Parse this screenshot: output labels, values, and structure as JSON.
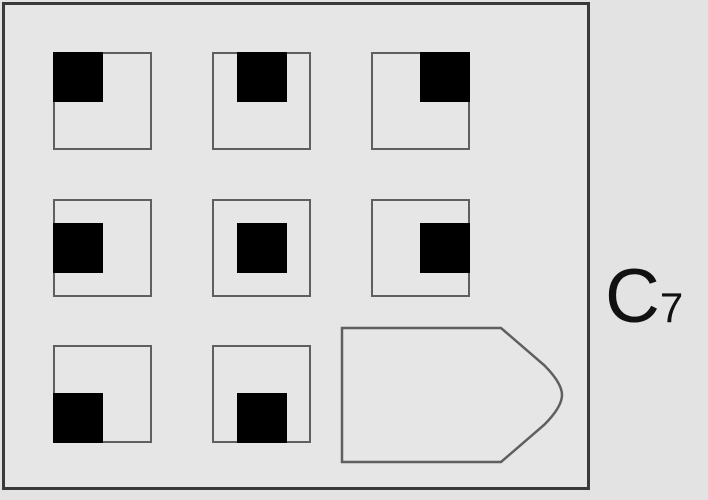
{
  "puzzle": {
    "label": {
      "text": "C",
      "subscript": "7"
    },
    "matrix": {
      "rows": 3,
      "cols": 3,
      "cells": [
        {
          "position": "row1-col1",
          "type": "square",
          "fill_position": "top-left"
        },
        {
          "position": "row1-col2",
          "type": "square",
          "fill_position": "top-center"
        },
        {
          "position": "row1-col3",
          "type": "square",
          "fill_position": "top-right"
        },
        {
          "position": "row2-col1",
          "type": "square",
          "fill_position": "middle-left"
        },
        {
          "position": "row2-col2",
          "type": "square",
          "fill_position": "middle-center"
        },
        {
          "position": "row2-col3",
          "type": "square",
          "fill_position": "middle-right"
        },
        {
          "position": "row3-col1",
          "type": "square",
          "fill_position": "bottom-left"
        },
        {
          "position": "row3-col2",
          "type": "square",
          "fill_position": "bottom-center"
        },
        {
          "position": "row3-col3",
          "type": "answer-placeholder",
          "shape": "right-pointing-pentagon",
          "fill_position": null
        }
      ]
    },
    "colors": {
      "background": "#e3e3e3",
      "panel_fill": "#e6e6e6",
      "panel_border": "#3a3a3a",
      "cell_border": "#5f5f5f",
      "filled_square": "#000000",
      "label_text": "#111111"
    }
  }
}
